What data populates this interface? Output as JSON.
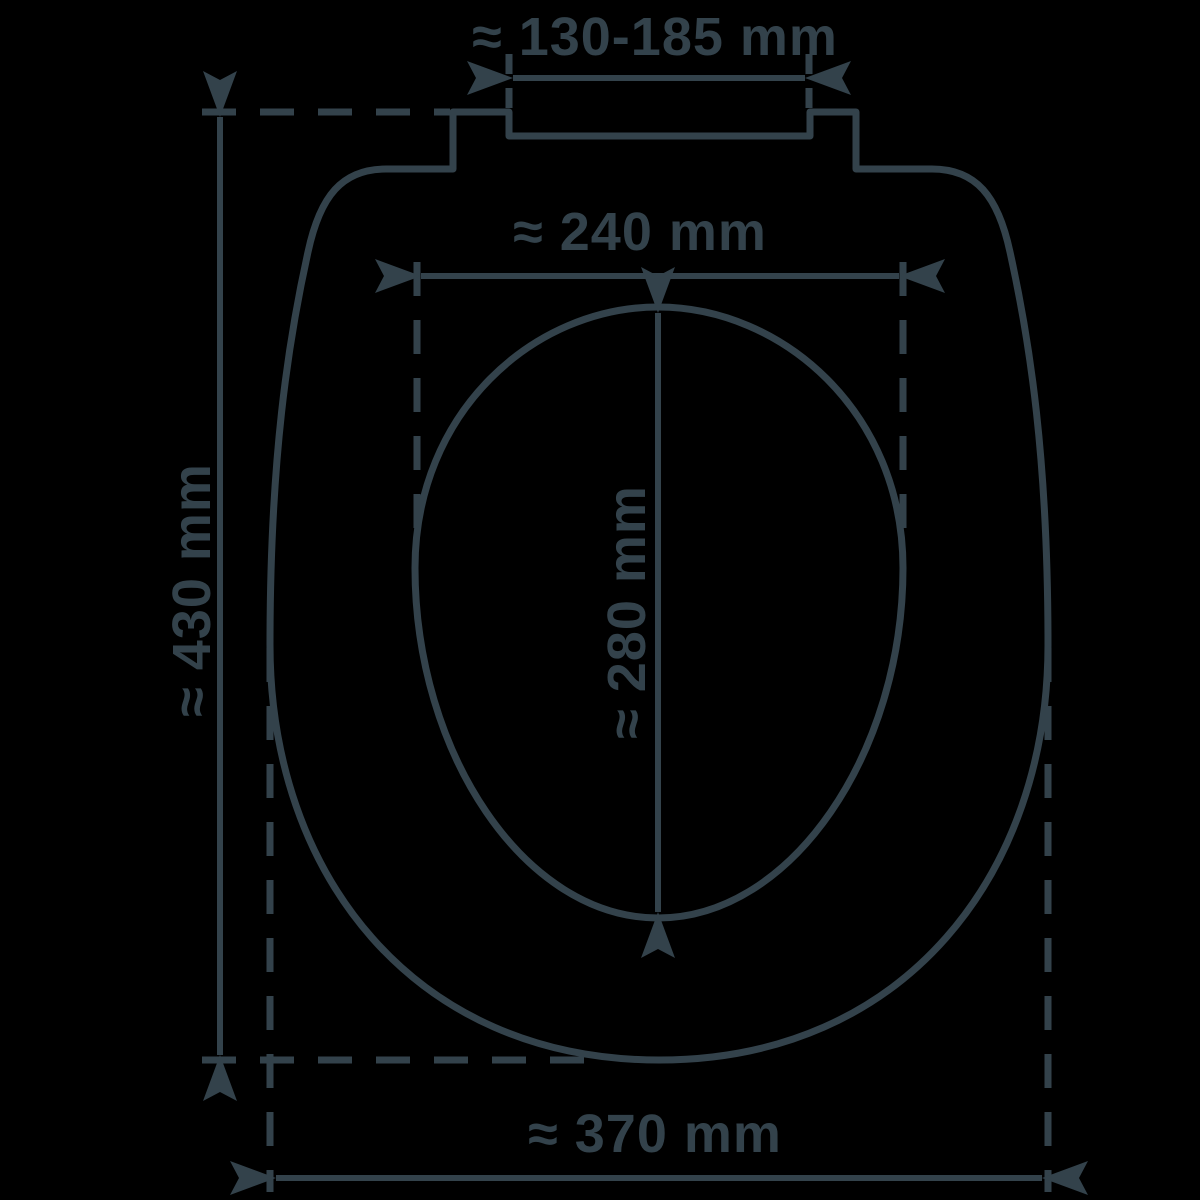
{
  "diagram": {
    "name": "toilet-seat-dimension-diagram",
    "background_color": "#000000",
    "line_color": "#33424b",
    "dimensions": {
      "hinge_hole_spacing": {
        "label": "≈ 130-185 mm",
        "orientation": "horizontal"
      },
      "inner_opening_width": {
        "label": "≈ 240 mm",
        "orientation": "horizontal"
      },
      "inner_opening_length": {
        "label": "≈ 280 mm",
        "orientation": "vertical"
      },
      "overall_length": {
        "label": "≈ 430 mm",
        "orientation": "vertical"
      },
      "overall_width": {
        "label": "≈ 370 mm",
        "orientation": "horizontal"
      }
    }
  }
}
